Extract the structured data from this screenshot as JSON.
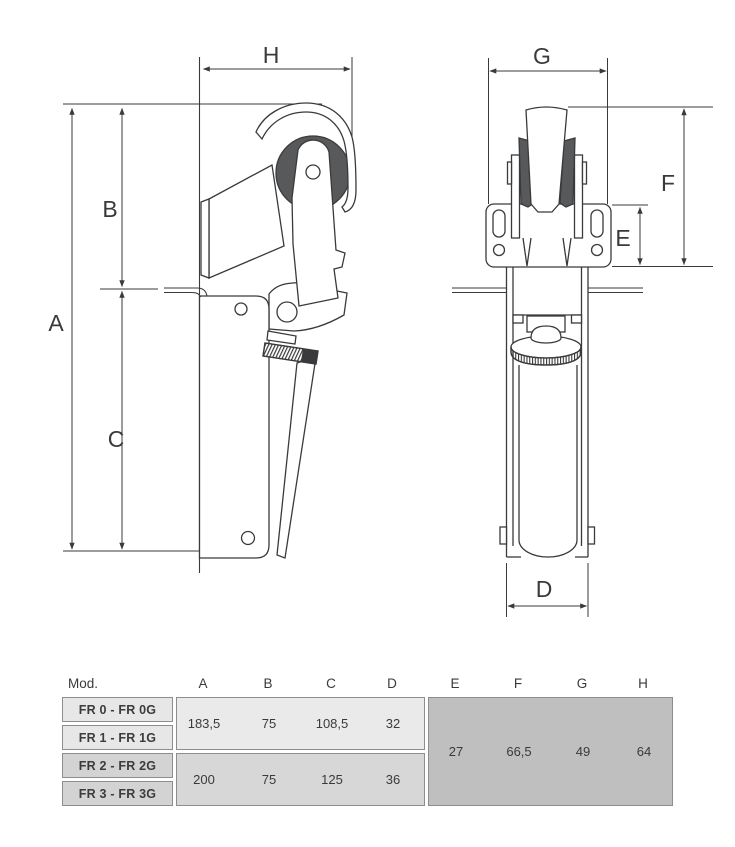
{
  "dims": {
    "A": "A",
    "B": "B",
    "C": "C",
    "D": "D",
    "E": "E",
    "F": "F",
    "G": "G",
    "H": "H"
  },
  "table": {
    "mod_header": "Mod.",
    "col_headers": [
      "A",
      "B",
      "C",
      "D",
      "E",
      "F",
      "G",
      "H"
    ],
    "models": [
      "FR 0 - FR 0G",
      "FR 1 - FR 1G",
      "FR 2 - FR 2G",
      "FR 3 - FR 3G"
    ],
    "group_fr0_fr1": {
      "A": "183,5",
      "B": "75",
      "C": "108,5",
      "D": "32"
    },
    "group_fr2_fr3": {
      "A": "200",
      "B": "75",
      "C": "125",
      "D": "36"
    },
    "shared_all": {
      "E": "27",
      "F": "66,5",
      "G": "49",
      "H": "64"
    }
  },
  "colors": {
    "line": "#3a3a3c",
    "roller_fill": "#58595b",
    "cell_light": "#e7e7e7",
    "cell_mid": "#d3d3d3",
    "block_light": "#eaeaea",
    "block_mid": "#d7d7d7",
    "block_dark": "#bfbfbf",
    "border": "#8d8d8d"
  }
}
